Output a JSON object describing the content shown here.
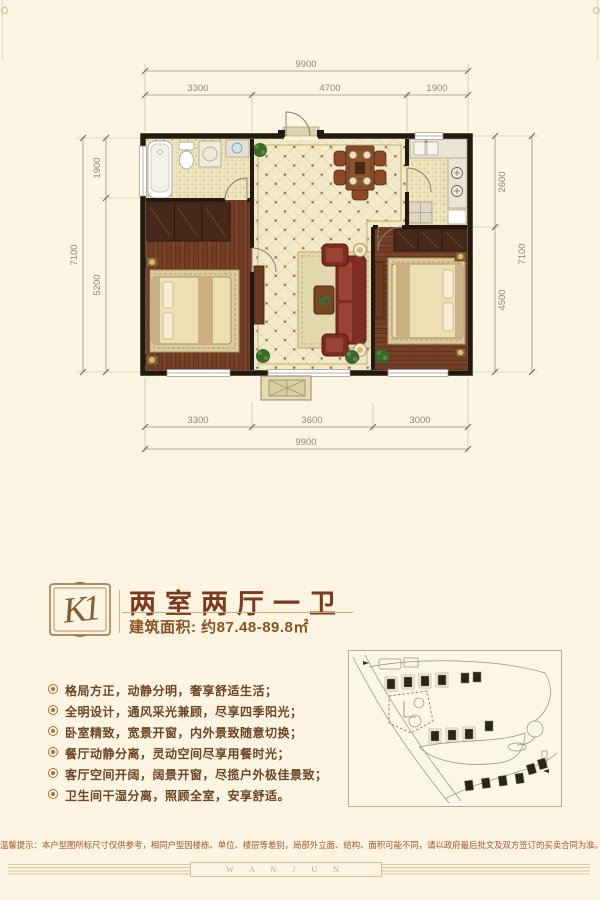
{
  "colors": {
    "background": "#fdf5e2",
    "headline": "#7b3a1c",
    "accent_brown": "#9a6b42",
    "feature_text": "#6d4526",
    "disclaimer_text": "#a2552e",
    "sitemap_highlight": "#d4654a"
  },
  "floor_plan": {
    "rooms": [
      "bathroom",
      "bedroom-left",
      "living-dining",
      "kitchen",
      "bedroom-right",
      "entry-porch"
    ],
    "dimensions": {
      "top_total": "9900",
      "top_segments": [
        "3300",
        "4700",
        "1900"
      ],
      "left_total": "7100",
      "left_segments": [
        "1900",
        "5200"
      ],
      "right_segments": [
        "2600",
        "4500"
      ],
      "right_total": "7100",
      "bottom_segments": [
        "3300",
        "3600",
        "3000"
      ],
      "bottom_total": "9900"
    }
  },
  "unit_info": {
    "badge": "K1",
    "title": "两室两厅一卫",
    "area_label": "建筑面积: 约87.48-89.8㎡"
  },
  "features": [
    "格局方正，动静分明，奢享舒适生活；",
    "全明设计，通风采光兼顾，尽享四季阳光；",
    "卧室精致，宽景开窗，内外景致随意切换；",
    "餐厅动静分离，灵动空间尽享用餐时光；",
    "客厅空间开阔，阔景开窗，尽揽户外极佳景致；",
    "卫生间干湿分离，照顾全室，安享舒适。"
  ],
  "disclaimer": "温馨提示：本户型图所标尺寸仅供参考，相同户型因楼栋、单位、楼层等差别，局部外立面、结构、面积可能不同，请以政府最后批文及双方签订的买卖合同为准。",
  "footer_brand": "W A N J U N"
}
